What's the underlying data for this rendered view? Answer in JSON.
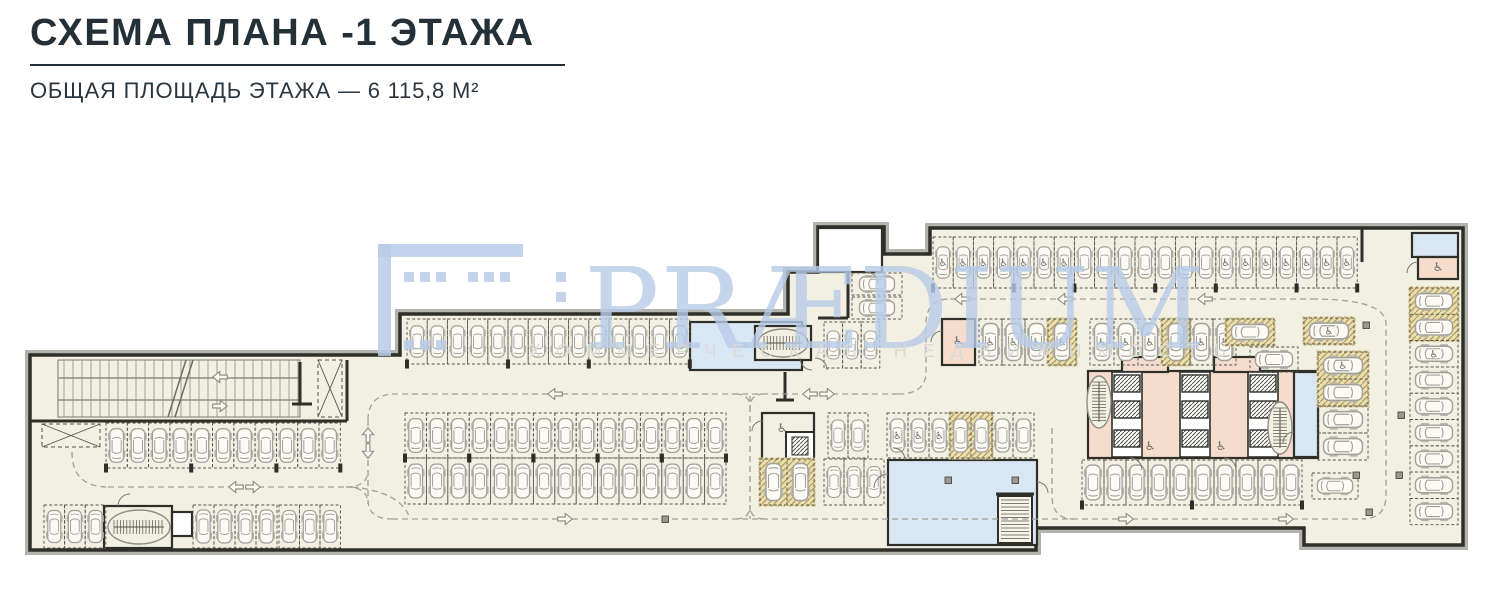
{
  "header": {
    "title": "СХЕМА ПЛАНА -1 ЭТАЖА",
    "subtitle": "ОБЩАЯ ПЛОЩАДЬ ЭТАЖА — 6 115,8 М²"
  },
  "watermark": {
    "brand": "PRÆDIUM",
    "tagline": "КОММЕРЧЕСКАЯ НЕДВИЖИМОСТЬ",
    "color": "#b7cbe7",
    "tagline_color": "#d9d9d4"
  },
  "plan": {
    "floor": "#f2efe3",
    "wall": "#2f2f2a",
    "shadow": "#b3b3ae",
    "line": "#8f8e84",
    "spotLine": "#55544b",
    "laneColor": "#a2a195",
    "accChar": "♿",
    "colors": {
      "blue": "#d9e7f5",
      "pink": "#f6dccd",
      "white": "#ffffff",
      "floor": "#f2efe3"
    },
    "outline": "M30 355 L400 355 L400 314 L788 314 L788 272 L818 272 L818 227 L884 227 L884 254 L930 254 L930 228 L1463 228 L1463 545 L1304 545 L1304 528 L1036 528 L1036 550 L30 550 Z",
    "rooms": [
      {
        "x": 690,
        "y": 322,
        "w": 112,
        "h": 48,
        "f": "blue"
      },
      {
        "x": 755,
        "y": 326,
        "w": 56,
        "h": 34,
        "f": "floor"
      },
      {
        "x": 818,
        "y": 228,
        "w": 64,
        "h": 44,
        "f": "white"
      },
      {
        "x": 888,
        "y": 460,
        "w": 149,
        "h": 85,
        "f": "blue"
      },
      {
        "x": 1412,
        "y": 233,
        "w": 46,
        "h": 24,
        "f": "blue"
      },
      {
        "x": 1418,
        "y": 257,
        "w": 40,
        "h": 22,
        "f": "pink"
      },
      {
        "x": 942,
        "y": 319,
        "w": 33,
        "h": 46,
        "f": "pink"
      },
      {
        "x": 1088,
        "y": 371,
        "w": 230,
        "h": 87,
        "f": "pink"
      },
      {
        "x": 1122,
        "y": 357,
        "w": 46,
        "h": 15,
        "f": "pink"
      },
      {
        "x": 1214,
        "y": 357,
        "w": 46,
        "h": 15,
        "f": "pink"
      },
      {
        "x": 1294,
        "y": 372,
        "w": 24,
        "h": 85,
        "f": "blue"
      },
      {
        "x": 762,
        "y": 413,
        "w": 52,
        "h": 47,
        "f": "floor"
      },
      {
        "x": 104,
        "y": 506,
        "w": 68,
        "h": 42,
        "f": "floor"
      },
      {
        "x": 172,
        "y": 512,
        "w": 20,
        "h": 24,
        "f": "white"
      }
    ],
    "core": {
      "corridors": [
        1112,
        1180,
        1248
      ],
      "y": 372,
      "h": 85,
      "w": 30,
      "shaftYs": [
        375,
        401,
        430
      ]
    },
    "stairsOval": [
      [
        139,
        527,
        31,
        17,
        0
      ],
      [
        783,
        343,
        25,
        14,
        0
      ],
      [
        1099,
        402,
        12,
        26,
        1
      ],
      [
        1280,
        428,
        12,
        26,
        1
      ]
    ],
    "stairLadder": [
      998,
      496,
      34,
      47
    ],
    "elevator": [
      786,
      432,
      28,
      28
    ],
    "ramp": {
      "x": 58,
      "y": 360,
      "w": 242,
      "h": 57
    },
    "hatchBoxes": [
      [
        42,
        424,
        58,
        23
      ],
      [
        318,
        360,
        24,
        57
      ]
    ],
    "walls": [
      "M30 421 H347",
      "M347 360 V421",
      "M818 318 H848",
      "M848 272 V318",
      "M785 372 V400",
      "M776 400 H794",
      "M1362 228 V262",
      "M996 494 H1034",
      "M300 362 V404",
      "M292 404 H312"
    ],
    "arcs": [
      "M874 488 A14 14 0 0 1 888 474",
      "M800 358 A12 12 0 0 0 812 370",
      "M815 358 A12 12 0 0 1 827 370",
      "M866 272 A12 12 0 0 1 878 284",
      "M942 331 A11 11 0 0 0 931 342",
      "M1418 262 A11 11 0 0 0 1407 273",
      "M1130 458 A12 12 0 0 1 1142 470",
      "M1224 458 A12 12 0 0 1 1236 470",
      "M762 421 A10 10 0 0 0 752 431",
      "M118 506 A12 12 0 0 1 130 494",
      "M1294 432 A11 11 0 0 0 1283 443",
      "M905 460 A12 12 0 0 0 893 448",
      "M1037 482 A11 11 0 0 1 1048 493"
    ],
    "lanes": [
      "M72 452 Q72 487 108 487",
      "M108 487 H346",
      "M346 487 Q368 487 368 470",
      "M346 487 Q368 487 368 504",
      "M368 420 V500 Q368 519 392 519",
      "M368 420 Q368 396 392 394",
      "M352 487 Q402 492 410 519",
      "M392 394 H898",
      "M898 394 Q926 394 926 372 V324 Q926 299 950 299",
      "M950 299 H1312",
      "M1312 299 Q1386 299 1386 324 V495 Q1386 519 1362 519",
      "M392 519 H1362",
      "M750 396 V519",
      "M736 394 Q750 394 750 408",
      "M764 394 Q750 394 750 408",
      "M736 519 Q750 519 750 505",
      "M764 519 Q750 519 750 505",
      "M1052 428 V496 Q1052 519 1074 519"
    ],
    "arrows": [
      [
        236,
        487,
        "l"
      ],
      [
        253,
        487,
        "r"
      ],
      [
        368,
        435,
        "u"
      ],
      [
        368,
        451,
        "d"
      ],
      [
        555,
        394,
        "l"
      ],
      [
        810,
        394,
        "l"
      ],
      [
        827,
        394,
        "r"
      ],
      [
        220,
        377,
        "l"
      ],
      [
        220,
        406,
        "r"
      ],
      [
        962,
        299,
        "l"
      ],
      [
        1065,
        299,
        "l"
      ],
      [
        1205,
        299,
        "l"
      ],
      [
        565,
        519,
        "r"
      ],
      [
        1126,
        519,
        "r"
      ],
      [
        1286,
        519,
        "r"
      ]
    ],
    "rows": [
      {
        "x": 106,
        "y": 423,
        "n": 11,
        "w": 21.3,
        "h": 45,
        "d": "down",
        "t": [
          0,
          4,
          8,
          11
        ]
      },
      {
        "x": 44,
        "y": 505,
        "n": 3,
        "w": 20.6,
        "h": 43,
        "d": "up"
      },
      {
        "x": 193,
        "y": 505,
        "n": 4,
        "w": 21,
        "h": 43,
        "d": "up"
      },
      {
        "x": 279,
        "y": 505,
        "n": 3,
        "w": 20.5,
        "h": 43,
        "d": "up"
      },
      {
        "x": 407,
        "y": 319,
        "n": 14,
        "w": 20.2,
        "h": 45,
        "d": "down",
        "t": [
          0,
          5,
          9,
          14
        ]
      },
      {
        "x": 824,
        "y": 322,
        "n": 3,
        "w": 18.6,
        "h": 46,
        "d": "down"
      },
      {
        "x": 405,
        "y": 413,
        "n": 15,
        "w": 21.4,
        "h": 45,
        "d": "down",
        "t": [
          0,
          3,
          6,
          9,
          12,
          15
        ]
      },
      {
        "x": 405,
        "y": 458,
        "n": 15,
        "w": 21.4,
        "h": 46,
        "d": "up",
        "t": [
          0,
          3,
          6,
          9,
          12,
          15
        ]
      },
      {
        "x": 828,
        "y": 413,
        "n": 2,
        "w": 20,
        "h": 45,
        "d": "down"
      },
      {
        "x": 887,
        "y": 413,
        "n": 7,
        "w": 21,
        "h": 45,
        "d": "down",
        "hz": [
          3,
          4
        ],
        "a": [
          0,
          1,
          2
        ]
      },
      {
        "x": 760,
        "y": 459,
        "n": 2,
        "w": 27,
        "h": 46,
        "d": "up",
        "hz": [
          0,
          1
        ]
      },
      {
        "x": 824,
        "y": 459,
        "n": 3,
        "w": 20,
        "h": 46,
        "d": "up"
      },
      {
        "x": 933,
        "y": 237,
        "n": 21,
        "w": 20.2,
        "h": 51,
        "d": "down",
        "a": [
          0,
          1,
          2,
          3,
          4,
          5,
          6,
          14,
          15,
          16,
          17,
          18,
          19,
          20
        ],
        "t": [
          0,
          4,
          7,
          11,
          14,
          18,
          21
        ]
      },
      {
        "x": 979,
        "y": 319,
        "n": 3,
        "w": 23,
        "h": 46,
        "d": "down",
        "a": [
          0,
          1,
          2
        ]
      },
      {
        "x": 1048,
        "y": 319,
        "n": 1,
        "w": 28,
        "h": 46,
        "d": "down",
        "hz": [
          0
        ],
        "a": [
          0
        ]
      },
      {
        "x": 1090,
        "y": 319,
        "n": 3,
        "w": 24,
        "h": 46,
        "d": "down",
        "a": [
          0,
          1,
          2
        ]
      },
      {
        "x": 1162,
        "y": 319,
        "n": 1,
        "w": 28,
        "h": 46,
        "d": "down",
        "hz": [
          0
        ]
      },
      {
        "x": 1190,
        "y": 319,
        "n": 2,
        "w": 23,
        "h": 46,
        "d": "down",
        "a": [
          0,
          1
        ]
      },
      {
        "x": 1082,
        "y": 460,
        "n": 10,
        "w": 22,
        "h": 45,
        "d": "down",
        "t": [
          0,
          5,
          10
        ]
      },
      {
        "x": 852,
        "y": 273,
        "n": 1,
        "w": 50,
        "h": 22,
        "d": "left"
      },
      {
        "x": 852,
        "y": 297,
        "n": 1,
        "w": 50,
        "h": 22,
        "d": "left"
      },
      {
        "x": 1226,
        "y": 319,
        "n": 1,
        "w": 48,
        "h": 26,
        "d": "left",
        "hz": [
          0
        ]
      },
      {
        "x": 1250,
        "y": 347,
        "n": 1,
        "w": 48,
        "h": 25,
        "d": "left"
      },
      {
        "x": 1304,
        "y": 318,
        "n": 1,
        "w": 50,
        "h": 26,
        "d": "left",
        "hz": [
          0
        ],
        "a": [
          0
        ]
      },
      {
        "x": 1312,
        "y": 473,
        "n": 1,
        "w": 46,
        "h": 26,
        "d": "left"
      },
      {
        "x": 1318,
        "y": 352,
        "n": 2,
        "w": 50,
        "h": 27,
        "d": "left",
        "hz": [
          0,
          1
        ],
        "a": [
          0
        ]
      },
      {
        "x": 1318,
        "y": 406,
        "n": 2,
        "w": 50,
        "h": 27,
        "d": "left"
      },
      {
        "x": 1410,
        "y": 288,
        "n": 9,
        "w": 48,
        "h": 26.3,
        "d": "left",
        "hz": [
          0,
          1
        ],
        "a": [
          2
        ]
      }
    ],
    "columns": [
      [
        1363,
        322
      ],
      [
        1398,
        412
      ],
      [
        1353,
        472
      ],
      [
        1396,
        472
      ],
      [
        1366,
        509
      ],
      [
        945,
        477
      ],
      [
        1012,
        477
      ],
      [
        662,
        516
      ]
    ],
    "accPoints": [
      [
        958,
        345
      ],
      [
        1438,
        271
      ],
      [
        1150,
        450
      ],
      [
        1221,
        450
      ],
      [
        782,
        432
      ]
    ]
  }
}
